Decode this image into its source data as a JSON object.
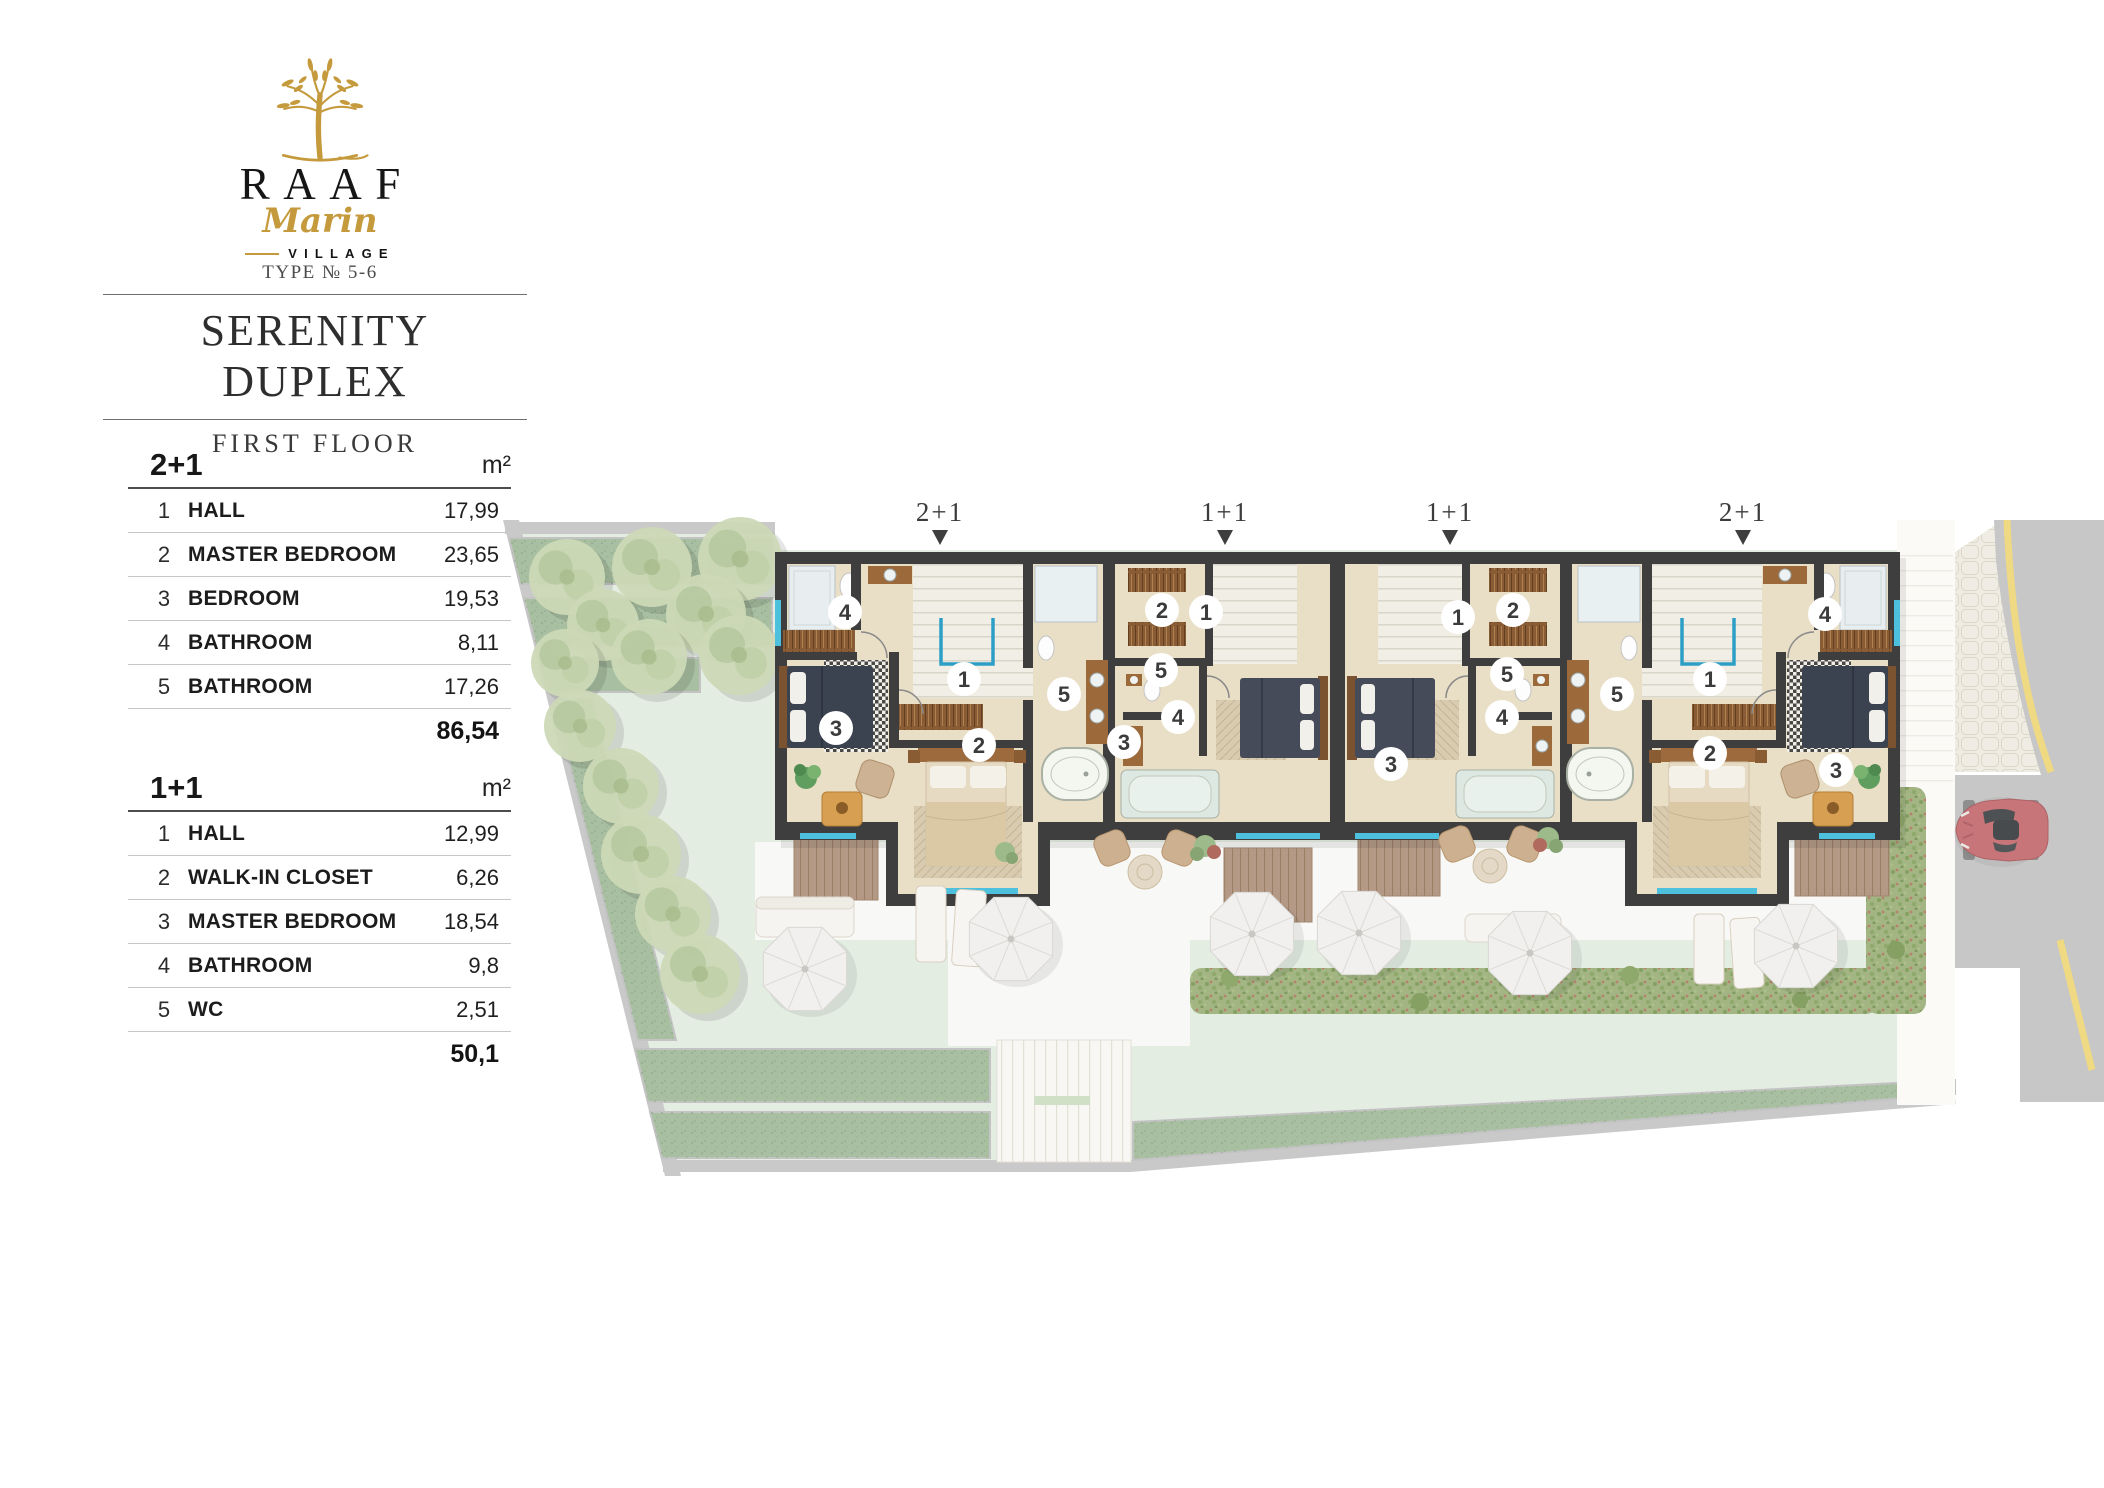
{
  "brand": {
    "name": "RAAF",
    "script": "Marin",
    "village": "VILLAGE",
    "type_label": "TYPE № 5-6"
  },
  "header": {
    "title": "SERENITY DUPLEX",
    "subtitle": "FIRST FLOOR"
  },
  "tables": [
    {
      "title": "2+1",
      "unit": "m²",
      "rows": [
        [
          "1",
          "HALL",
          "17,99"
        ],
        [
          "2",
          "MASTER BEDROOM",
          "23,65"
        ],
        [
          "3",
          "BEDROOM",
          "19,53"
        ],
        [
          "4",
          "BATHROOM",
          "8,11"
        ],
        [
          "5",
          "BATHROOM",
          "17,26"
        ]
      ],
      "total": "86,54"
    },
    {
      "title": "1+1",
      "unit": "m²",
      "rows": [
        [
          "1",
          "HALL",
          "12,99"
        ],
        [
          "2",
          "WALK-IN CLOSET",
          "6,26"
        ],
        [
          "3",
          "MASTER BEDROOM",
          "18,54"
        ],
        [
          "4",
          "BATHROOM",
          "9,8"
        ],
        [
          "5",
          "WC",
          "2,51"
        ]
      ],
      "total": "50,1"
    }
  ],
  "plan": {
    "units": [
      {
        "label": "2+1",
        "rooms": [
          "1",
          "2",
          "3",
          "4",
          "5"
        ]
      },
      {
        "label": "1+1",
        "rooms": [
          "1",
          "2",
          "3",
          "4",
          "5"
        ]
      },
      {
        "label": "1+1",
        "rooms": [
          "1",
          "2",
          "3",
          "4",
          "5"
        ]
      },
      {
        "label": "2+1",
        "rooms": [
          "1",
          "2",
          "3",
          "4",
          "5"
        ]
      }
    ]
  },
  "colors": {
    "gold": "#C49A3C",
    "wall": "#3F3E3E",
    "floor": "#E9DEC6",
    "cyan": "#4CC0DD",
    "lawn": "#E4EDE2",
    "strip": "#A9BFA2",
    "road": "#C7C7C7",
    "roadline": "#F1DA7E",
    "car": "#C96468",
    "deck": "#B39884"
  }
}
